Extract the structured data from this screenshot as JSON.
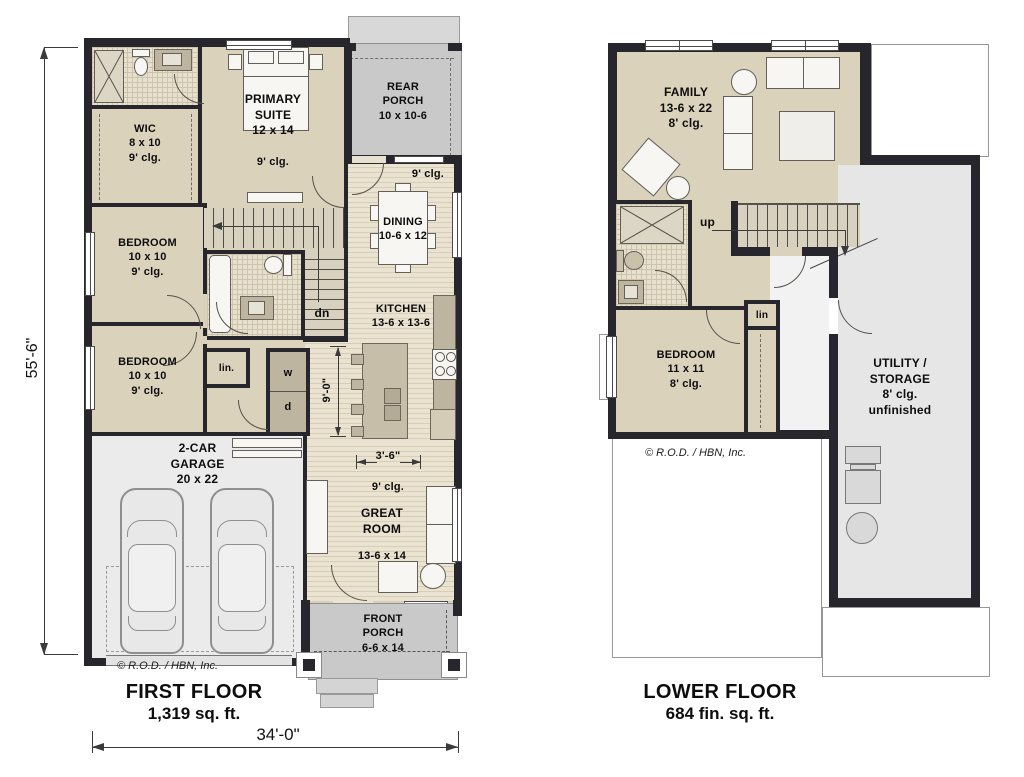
{
  "first_floor": {
    "title": "FIRST FLOOR",
    "area": "1,319 sq. ft.",
    "copyright": "© R.O.D. / HBN, Inc.",
    "dim_w": "34'-0\"",
    "dim_h": "55'-6\"",
    "wic": {
      "l1": "WIC",
      "l2": "8 x 10",
      "l3": "9' clg."
    },
    "primary": {
      "l1": "PRIMARY",
      "l2": "SUITE",
      "l3": "12 x 14",
      "clg": "9' clg."
    },
    "rear_porch": {
      "l1": "REAR",
      "l2": "PORCH",
      "l3": "10 x 10-6"
    },
    "dining": {
      "clg": "9' clg.",
      "l1": "DINING",
      "l2": "10-6 x 12"
    },
    "kitchen": {
      "l1": "KITCHEN",
      "l2": "13-6 x 13-6"
    },
    "bedroom1": {
      "l1": "BEDROOM",
      "l2": "10 x 10",
      "l3": "9' clg."
    },
    "bedroom2": {
      "l1": "BEDROOM",
      "l2": "10 x 10",
      "l3": "9' clg."
    },
    "garage": {
      "l1": "2-CAR",
      "l2": "GARAGE",
      "l3": "20 x 22"
    },
    "great_room": {
      "dim": "3'-6\"",
      "clg": "9' clg.",
      "l1": "GREAT",
      "l2": "ROOM",
      "l3": "13-6 x 14"
    },
    "front_porch": {
      "l1": "FRONT",
      "l2": "PORCH",
      "l3": "6-6 x 14"
    },
    "labels": {
      "dn": "dn",
      "lin": "lin.",
      "w": "w",
      "d": "d",
      "island_depth": "9'-0\""
    }
  },
  "lower_floor": {
    "title": "LOWER FLOOR",
    "area": "684 fin. sq. ft.",
    "copyright": "© R.O.D. / HBN, Inc.",
    "family": {
      "l1": "FAMILY",
      "l2": "13-6 x 22",
      "l3": "8' clg."
    },
    "bedroom": {
      "l1": "BEDROOM",
      "l2": "11 x 11",
      "l3": "8' clg."
    },
    "utility": {
      "l1": "UTILITY /",
      "l2": "STORAGE",
      "l3": "8' clg.",
      "l4": "unfinished"
    },
    "labels": {
      "up": "up",
      "lin": "lin"
    }
  },
  "colors": {
    "wall": "#26262c",
    "floor": "#dbd2bc",
    "porch": "#c9c9c9",
    "garage": "#ebebeb",
    "utility": "#e6e6e6"
  }
}
